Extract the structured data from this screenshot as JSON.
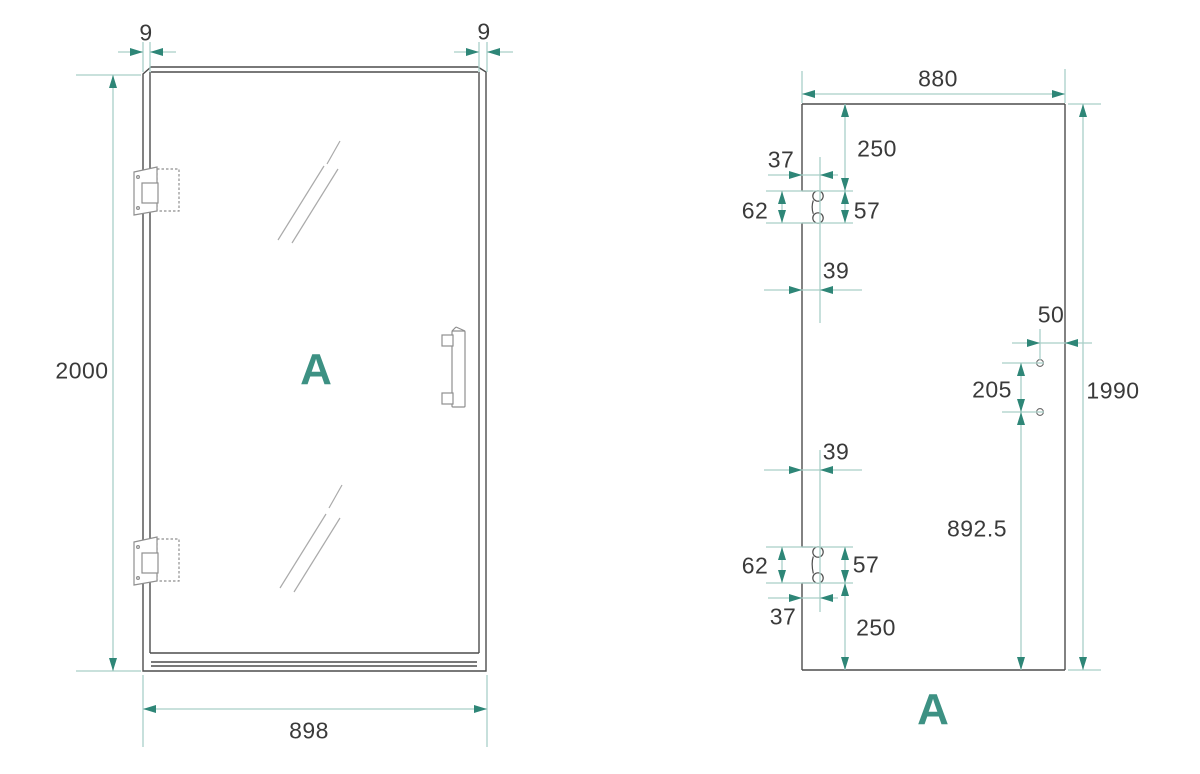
{
  "drawing": {
    "title_visible": false,
    "colors": {
      "background": "#ffffff",
      "outline_dark": "#4d4d4d",
      "hardware_gray": "#8f8f8f",
      "shine_gray": "#aaaaaa",
      "dimension_line_teal": "#a9cfc8",
      "arrowhead_teal": "#2e8677",
      "dimension_text": "#3a3a3a",
      "view_label_teal": "#3d9183"
    },
    "left_view": {
      "label": "A",
      "dim_top_left_edge": "9",
      "dim_top_right_edge": "9",
      "dim_total_height": "2000",
      "dim_total_width": "898"
    },
    "right_view": {
      "label": "A",
      "dim_glass_width": "880",
      "dim_glass_height": "1990",
      "dim_top_cutout_from_top": "250",
      "dim_top_cutout_offset_a": "37",
      "dim_top_cutout_height": "62",
      "dim_top_cutout_hole_spacing": "57",
      "dim_top_cutout_offset_b": "39",
      "dim_handle_hole_from_edge": "50",
      "dim_handle_hole_spacing": "205",
      "dim_handle_hole_from_bottom": "892.5",
      "dim_bottom_cutout_offset_b": "39",
      "dim_bottom_cutout_height": "62",
      "dim_bottom_cutout_hole_spacing": "57",
      "dim_bottom_cutout_offset_a": "37",
      "dim_bottom_cutout_from_bottom": "250"
    }
  }
}
